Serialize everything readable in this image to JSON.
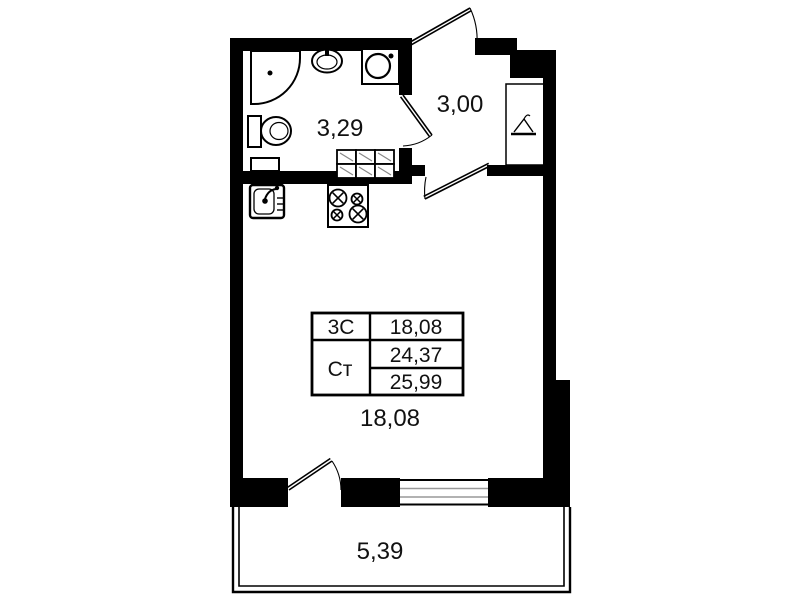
{
  "plan_type": "studio-apartment-floor-plan",
  "labels": {
    "bathroom_area": "3,29",
    "hallway_area": "3,00",
    "living_area": "18,08",
    "balcony_area": "5,39"
  },
  "area_table": {
    "type_label": "3С",
    "living_value": "18,08",
    "studio_label": "Ст",
    "total_value": "24,37",
    "total_with_balcony_value": "25,99"
  },
  "icons": {
    "bathtub-icon": "corner shower tray with drain dot",
    "washbasin-icon": "oval sink with faucet",
    "washing-machine-icon": "square with drum circle",
    "toilet-icon": "tank with oval bowl",
    "kitchen-sink-icon": "rounded square sink with faucet",
    "stove-icon": "four burner cooktop",
    "hanger-icon": "coat hanger (wardrobe niche)",
    "vent-grid-icon": "hatched duct grid"
  },
  "colors": {
    "wall": "#000000",
    "background": "#ffffff",
    "thin_line": "#000000",
    "hatch_line": "#888888",
    "window_mid_line": "#999999",
    "text": "#111111"
  }
}
